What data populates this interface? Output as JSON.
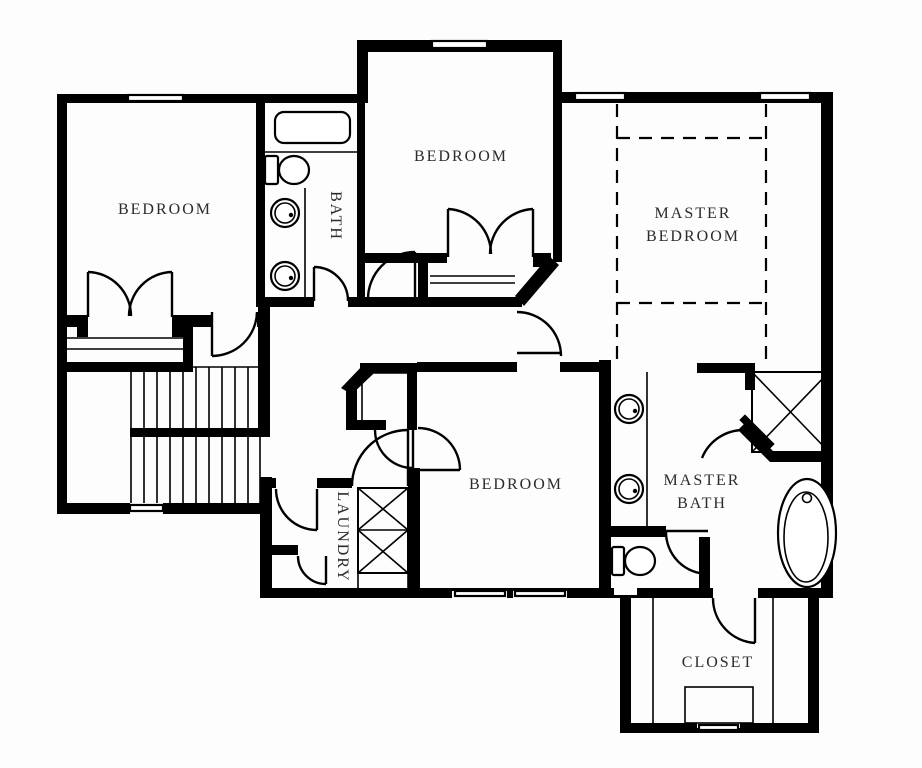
{
  "plan": {
    "title": "second-floor-plan",
    "rooms": {
      "bedroom_left": {
        "label": "BEDROOM"
      },
      "bedroom_top": {
        "label": "BEDROOM"
      },
      "master_bedroom": {
        "label_line1": "MASTER",
        "label_line2": "BEDROOM"
      },
      "bath": {
        "label": "BATH"
      },
      "bedroom_bottom": {
        "label": "BEDROOM"
      },
      "laundry": {
        "label": "LAUNDRY"
      },
      "master_bath": {
        "label_line1": "MASTER",
        "label_line2": "BATH"
      },
      "closet": {
        "label": "CLOSET"
      }
    },
    "colors": {
      "wall": "#000000",
      "background": "#ffffff",
      "label": "#2b2b2b"
    }
  }
}
